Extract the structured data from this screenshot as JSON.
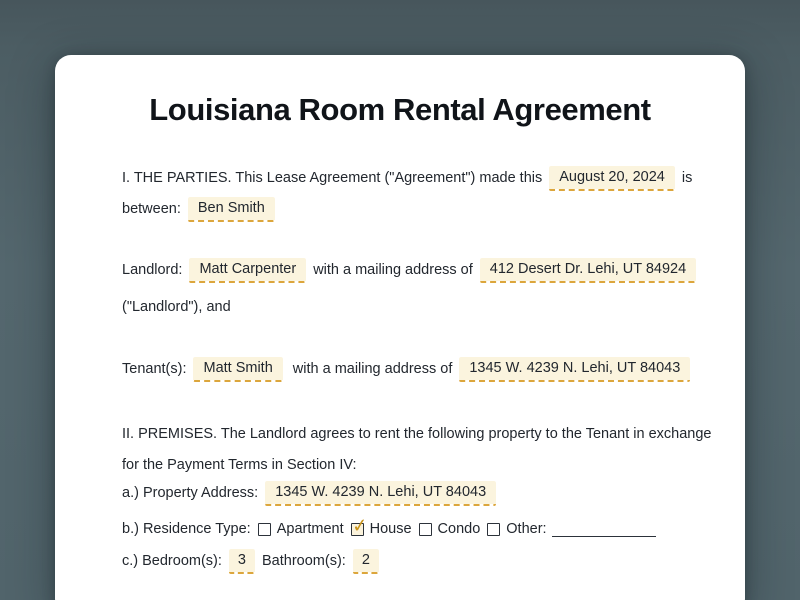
{
  "title": "Louisiana Room Rental Agreement",
  "parties": {
    "line1": "I. THE PARTIES. This Lease Agreement (\"Agreement\") made this",
    "date": "August 20, 2024",
    "after_date": "is",
    "line2_label": "between:",
    "party_name": "Ben Smith"
  },
  "landlord": {
    "label": "Landlord:",
    "name": "Matt Carpenter",
    "address_intro": "with a mailing address of",
    "address": "412 Desert Dr. Lehi, UT 84924",
    "closing": "(\"Landlord\"), and"
  },
  "tenant": {
    "label": "Tenant(s):",
    "name": "Matt Smith",
    "address_intro": "with a mailing address of",
    "address": "1345 W. 4239 N. Lehi, UT 84043"
  },
  "premises": {
    "line1": "II. PREMISES. The Landlord agrees to rent the following property to the Tenant in exchange",
    "line2": "for the Payment Terms in Section IV:",
    "property_label": "a.) Property Address:",
    "property_address": "1345 W. 4239 N. Lehi, UT 84043",
    "residence_label": "b.) Residence Type:",
    "options": [
      {
        "label": "Apartment",
        "checked": false
      },
      {
        "label": "House",
        "checked": true
      },
      {
        "label": "Condo",
        "checked": false
      },
      {
        "label": "Other:",
        "checked": false
      }
    ],
    "rooms_label": "c.) Bedroom(s):",
    "bedrooms": "3",
    "bathrooms_label": "Bathroom(s):",
    "bathrooms": "2"
  },
  "colors": {
    "page_background": "#53666D",
    "card_background": "#FFFFFF",
    "text": "#22272E",
    "field_background": "#FBF4DE",
    "field_dash": "#DCA63C",
    "checkmark": "#C9941C"
  }
}
